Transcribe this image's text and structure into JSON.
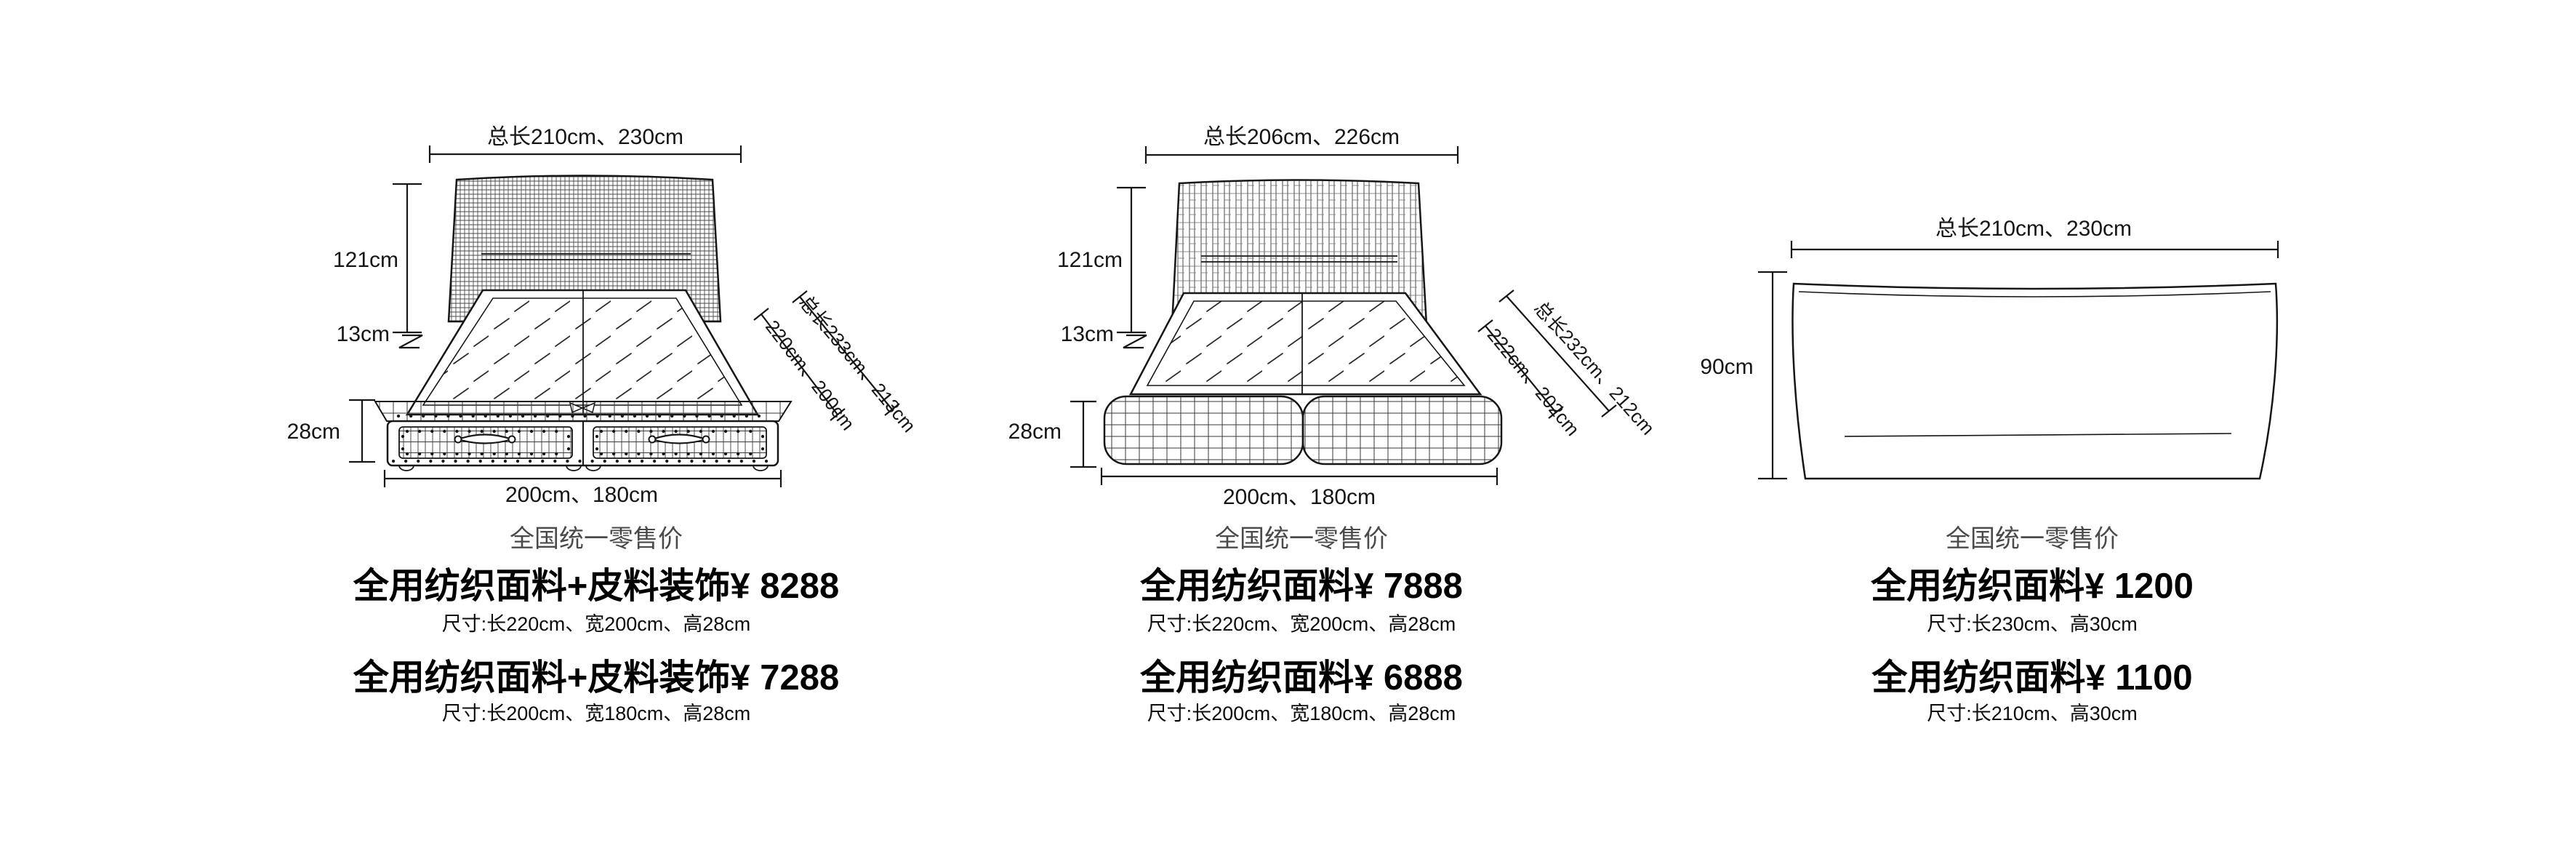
{
  "colors": {
    "line": "#161616",
    "texture": "#4a4a4a",
    "retail_gray": "#4a4a4a",
    "text_black": "#000000",
    "background": "#ffffff"
  },
  "products": [
    {
      "id": "storage-drawer-bed",
      "drawing": {
        "dim_top": "总长210cm、230cm",
        "dim_headboard_height": "121cm",
        "dim_step_height": "13cm",
        "dim_base_height": "28cm",
        "dim_bottom": "200cm、180cm",
        "dim_diag_outer": "总长233cm、213cm",
        "dim_diag_inner": "220cm、200cm"
      },
      "retail_label": "全国统一零售价",
      "offers": [
        {
          "price_line": "全用纺织面料+皮料装饰¥ 8288",
          "size_line": "尺寸:长220cm、宽200cm、高28cm"
        },
        {
          "price_line": "全用纺织面料+皮料装饰¥ 7288",
          "size_line": "尺寸:长200cm、宽180cm、高28cm"
        }
      ]
    },
    {
      "id": "upholstered-bed",
      "drawing": {
        "dim_top": "总长206cm、226cm",
        "dim_headboard_height": "121cm",
        "dim_step_height": "13cm",
        "dim_base_height": "28cm",
        "dim_bottom": "200cm、180cm",
        "dim_diag_outer": "总长232cm、212cm",
        "dim_diag_inner": "222cm、202cm"
      },
      "retail_label": "全国统一零售价",
      "offers": [
        {
          "price_line": "全用纺织面料¥ 7888",
          "size_line": "尺寸:长220cm、宽200cm、高28cm"
        },
        {
          "price_line": "全用纺织面料¥ 6888",
          "size_line": "尺寸:长200cm、宽180cm、高28cm"
        }
      ]
    },
    {
      "id": "headboard-panel",
      "drawing": {
        "dim_top": "总长210cm、230cm",
        "dim_height": "90cm"
      },
      "retail_label": "全国统一零售价",
      "offers": [
        {
          "price_line": "全用纺织面料¥ 1200",
          "size_line": "尺寸:长230cm、高30cm"
        },
        {
          "price_line": "全用纺织面料¥ 1100",
          "size_line": "尺寸:长210cm、高30cm"
        }
      ]
    }
  ]
}
